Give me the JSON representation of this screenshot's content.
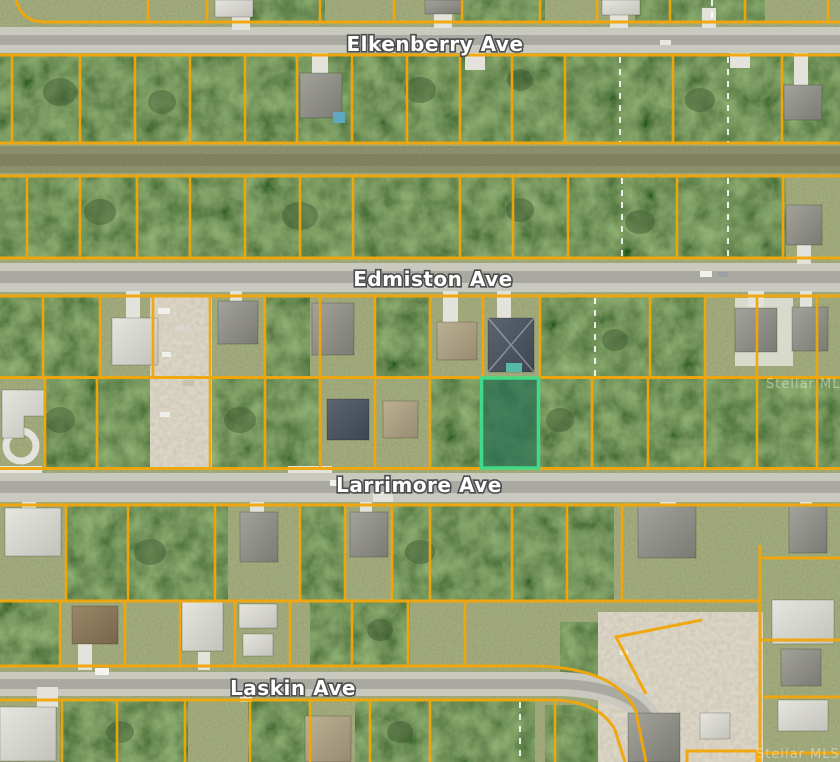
{
  "map": {
    "title": "Aerial parcel map with lot boundary overlay",
    "streets": {
      "elkenberry": "Elkenberry Ave",
      "edmiston": "Edmiston Ave",
      "larrimore": "Larrimore Ave",
      "laskin": "Laskin Ave"
    },
    "watermark": "Stellar MLS",
    "subject_parcel": {
      "state": "highlighted",
      "outline_color": "#3FDA8C",
      "fill_color": "#2A7154"
    },
    "overlay": {
      "parcel_line_color": "#F2A70A",
      "lot_split_dash_color": "#FFFFFF",
      "street_label_color": "#FFFFFF"
    }
  }
}
